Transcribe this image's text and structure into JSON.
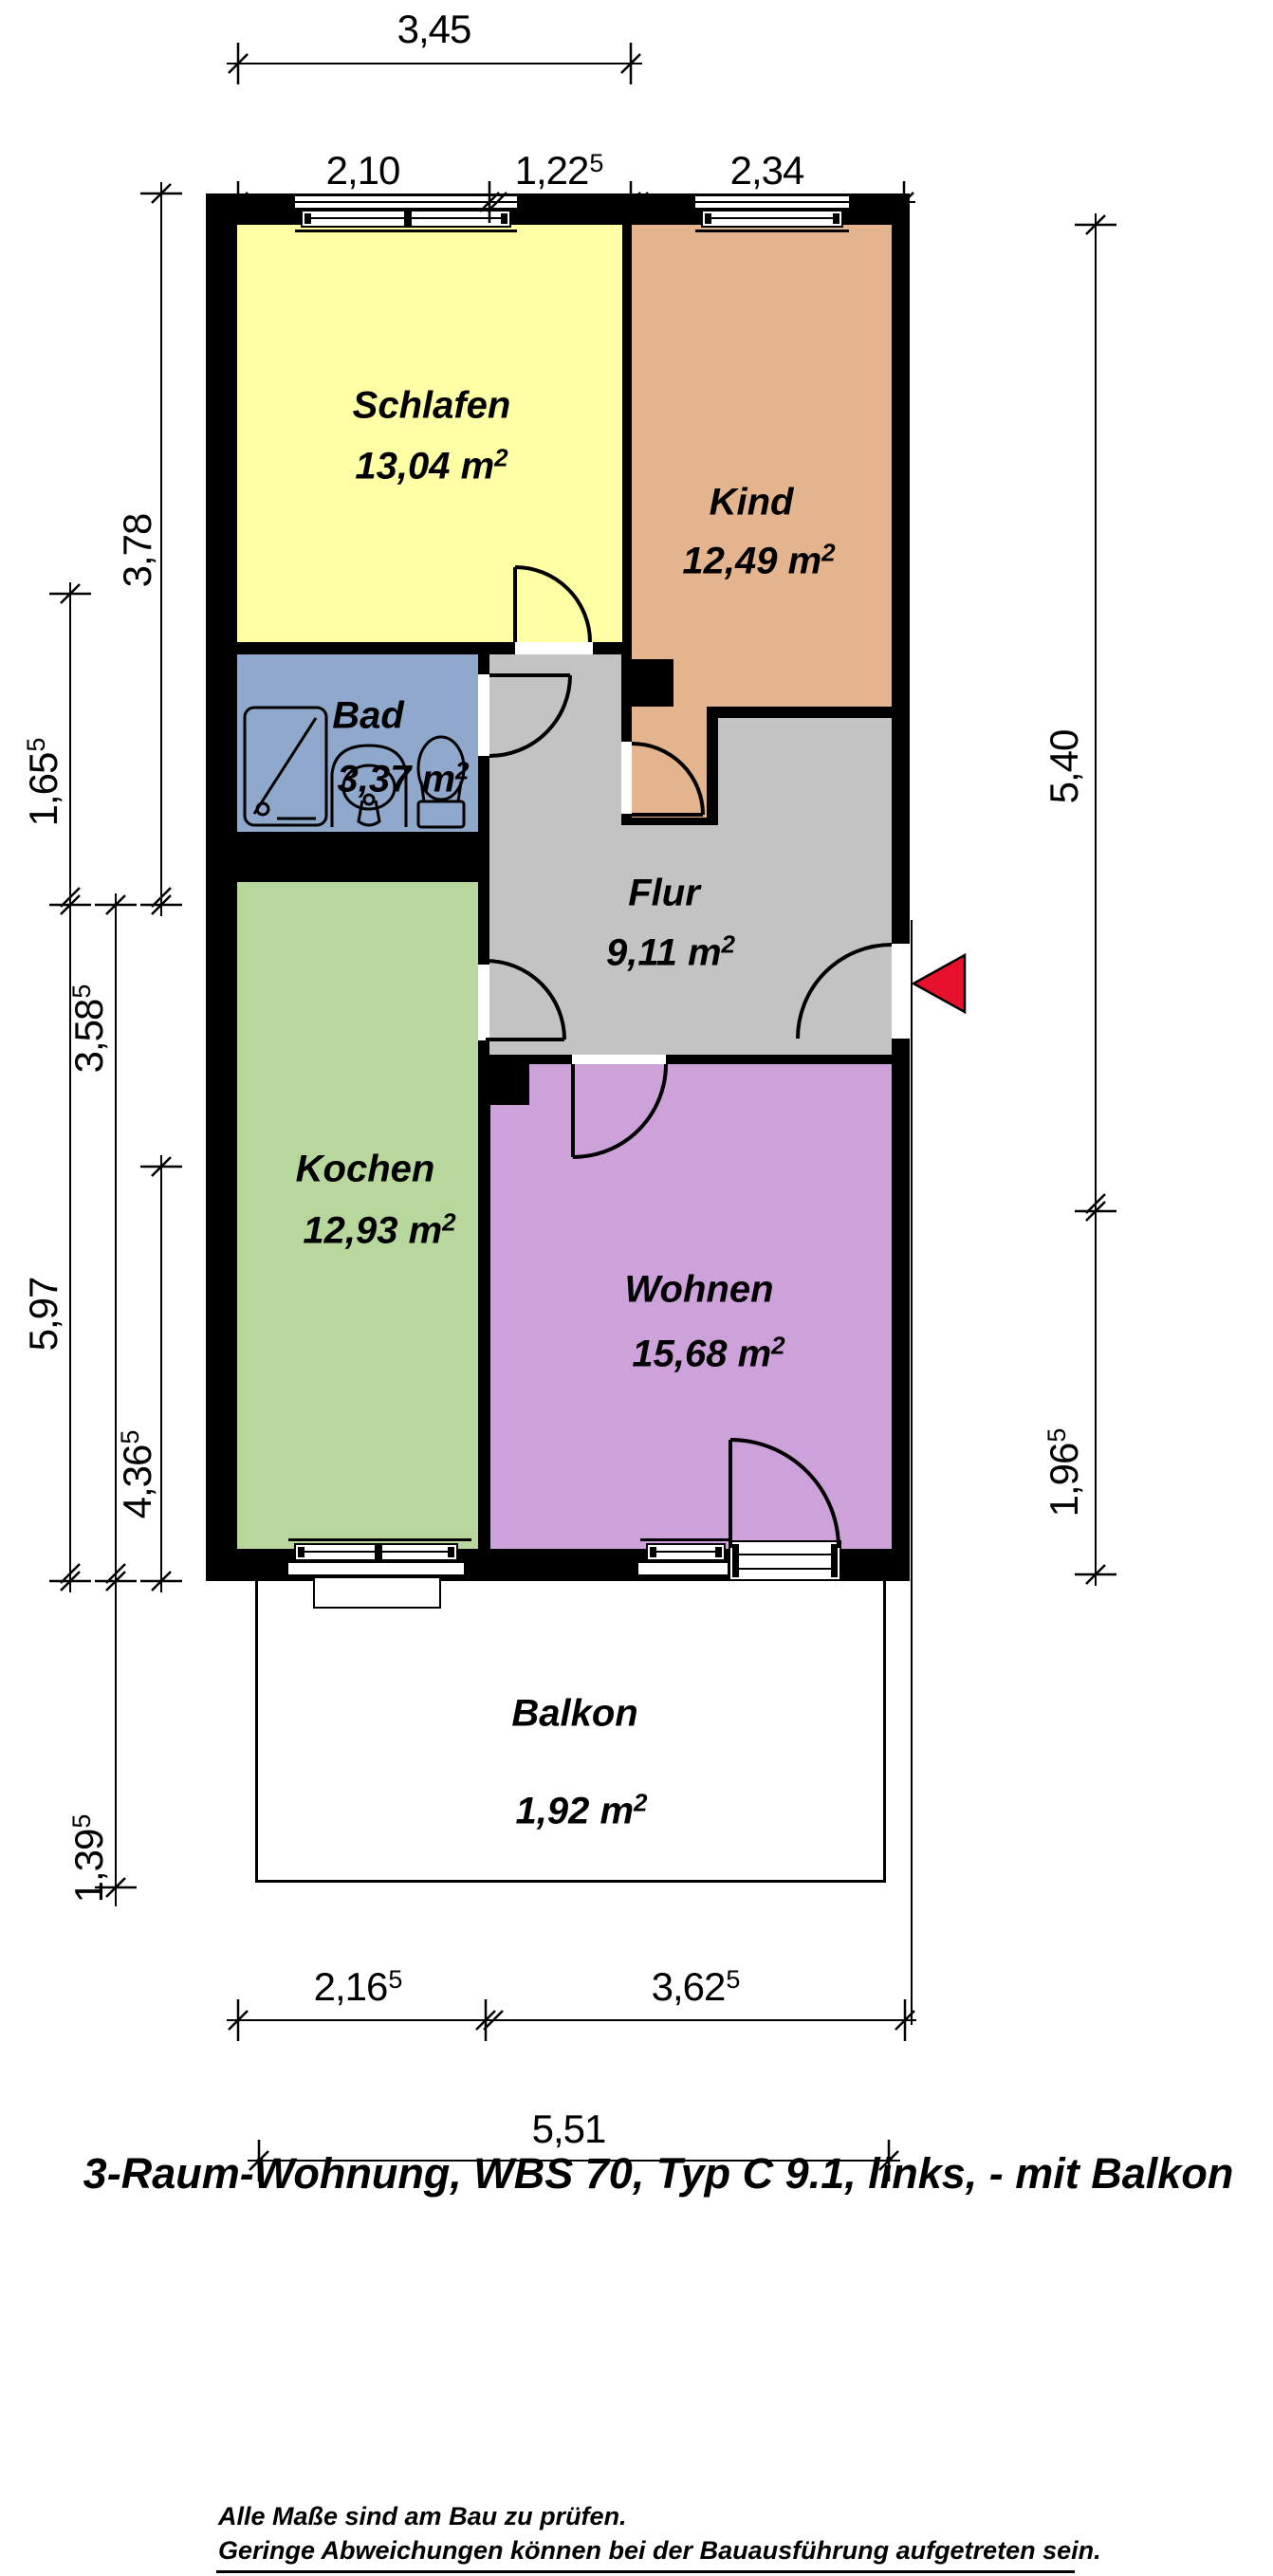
{
  "title": "3-Raum-Wohnung, WBS 70, Typ C 9.1, links, - mit Balkon",
  "footer": {
    "line1": "Alle Maße sind am Bau zu prüfen.",
    "line2": "Geringe Abweichungen können bei der Bauausführung aufgetreten sein."
  },
  "rooms": [
    {
      "name": "Schlafen",
      "area": "13,04 m",
      "area_sup": "2"
    },
    {
      "name": "Kind",
      "area": "12,49 m",
      "area_sup": "2"
    },
    {
      "name": "Bad",
      "area": "3,37 m",
      "area_sup": "2"
    },
    {
      "name": "Flur",
      "area": "9,11 m",
      "area_sup": "2"
    },
    {
      "name": "Kochen",
      "area": "12,93 m",
      "area_sup": "2"
    },
    {
      "name": "Wohnen",
      "area": "15,68 m",
      "area_sup": "2"
    },
    {
      "name": "Balkon",
      "area": "1,92 m",
      "area_sup": "2"
    }
  ],
  "dimensions": {
    "top": [
      {
        "value": "3,45",
        "sup": ""
      },
      {
        "value": "2,10",
        "sup": ""
      },
      {
        "value": "1,22",
        "sup": "5"
      },
      {
        "value": "2,34",
        "sup": ""
      }
    ],
    "left": [
      {
        "value": "3,78",
        "sup": ""
      },
      {
        "value": "1,65",
        "sup": "5"
      },
      {
        "value": "3,58",
        "sup": "5"
      },
      {
        "value": "5,97",
        "sup": ""
      },
      {
        "value": "4,36",
        "sup": "5"
      },
      {
        "value": "1,39",
        "sup": "5"
      }
    ],
    "right": [
      {
        "value": "5,40",
        "sup": ""
      },
      {
        "value": "1,96",
        "sup": "5"
      }
    ],
    "bottom": [
      {
        "value": "2,16",
        "sup": "5"
      },
      {
        "value": "3,62",
        "sup": "5"
      },
      {
        "value": "5,51",
        "sup": ""
      }
    ]
  },
  "colors": {
    "wall": "#000000",
    "schlafen": "#FFFFA6",
    "kind": "#E4B48E",
    "bad": "#8FA8CB",
    "flur": "#C3C3C3",
    "kochen": "#B7D79C",
    "wohnen": "#CDA2DB",
    "balkon": "#FFFFFF",
    "arrow": "#E8112D"
  }
}
